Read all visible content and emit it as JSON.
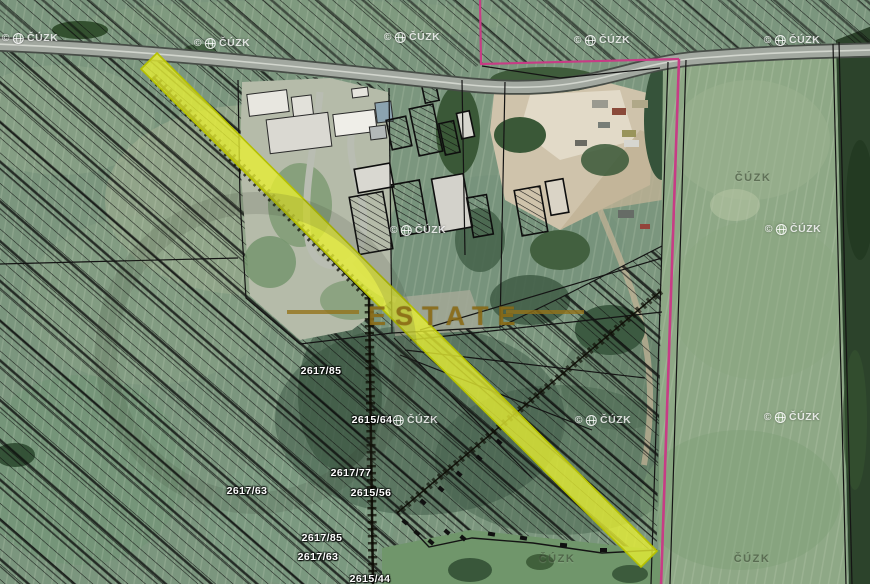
{
  "map": {
    "kind": "cadastral-aerial-map",
    "brand_watermark": "ESTATE",
    "copyright_symbol": "©",
    "provider": "ČÚZK",
    "colors": {
      "highlight_yellow": "#e8ef32",
      "boundary_pink": "#c73c85",
      "brand_gold": "rgba(148,114,24,0.78)",
      "parcel_label": "#ffffff",
      "hatch_black": "#0d0d0d"
    },
    "parcel_labels": [
      {
        "text": "2617/85",
        "x": 321,
        "y": 371
      },
      {
        "text": "2615/64",
        "x": 372,
        "y": 420
      },
      {
        "text": "2617/77",
        "x": 351,
        "y": 473
      },
      {
        "text": "2615/56",
        "x": 371,
        "y": 493
      },
      {
        "text": "2617/63",
        "x": 247,
        "y": 491
      },
      {
        "text": "2617/85",
        "x": 322,
        "y": 538
      },
      {
        "text": "2617/63",
        "x": 318,
        "y": 557
      },
      {
        "text": "2615/44",
        "x": 370,
        "y": 579
      }
    ],
    "copyright_watermarks": [
      {
        "x": 30,
        "y": 38
      },
      {
        "x": 222,
        "y": 43
      },
      {
        "x": 412,
        "y": 37
      },
      {
        "x": 602,
        "y": 40
      },
      {
        "x": 792,
        "y": 40
      },
      {
        "x": 418,
        "y": 230
      },
      {
        "x": 793,
        "y": 229
      },
      {
        "x": 410,
        "y": 420
      },
      {
        "x": 603,
        "y": 420
      },
      {
        "x": 792,
        "y": 417
      }
    ],
    "faint_watermarks": [
      {
        "x": 753,
        "y": 178
      },
      {
        "x": 557,
        "y": 559
      },
      {
        "x": 752,
        "y": 559
      }
    ]
  }
}
